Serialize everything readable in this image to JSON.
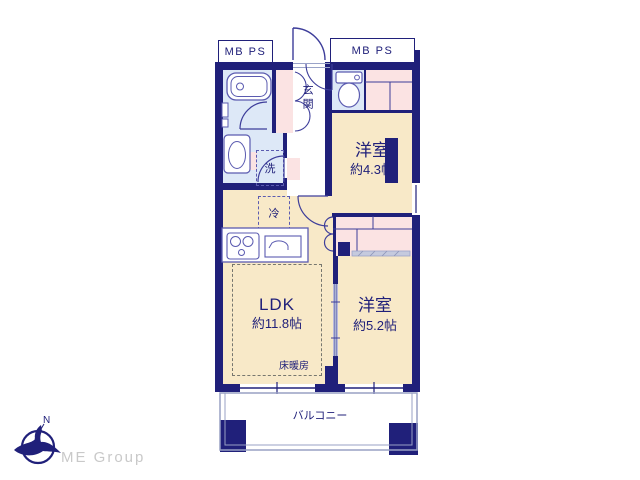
{
  "document_type": "apartment floor plan",
  "colors": {
    "wall_navy": "#20207a",
    "line_blue": "#5b5bb0",
    "room_cream": "#f8e9c8",
    "closet_pink": "#fbe3e3",
    "wet_area_blue": "#dde8f7",
    "balcony_rail": "#98a0c4",
    "logo_gray": "#c9c9c9"
  },
  "shafts": {
    "left_label": "MB PS",
    "right_label": "MB PS"
  },
  "rooms": {
    "entrance": {
      "label": "玄関"
    },
    "western_room_1": {
      "name": "洋室",
      "size": "約4.3帖"
    },
    "western_room_2": {
      "name": "洋室",
      "size": "約5.2帖"
    },
    "ldk": {
      "name": "LDK",
      "size": "約11.8帖",
      "floor_heating_label": "床暖房"
    },
    "balcony": {
      "label": "バルコニー"
    }
  },
  "fixtures": {
    "washer_label": "洗",
    "fridge_label": "冷"
  },
  "compass": {
    "north_label": "N"
  },
  "branding": {
    "company": "ME Group"
  }
}
